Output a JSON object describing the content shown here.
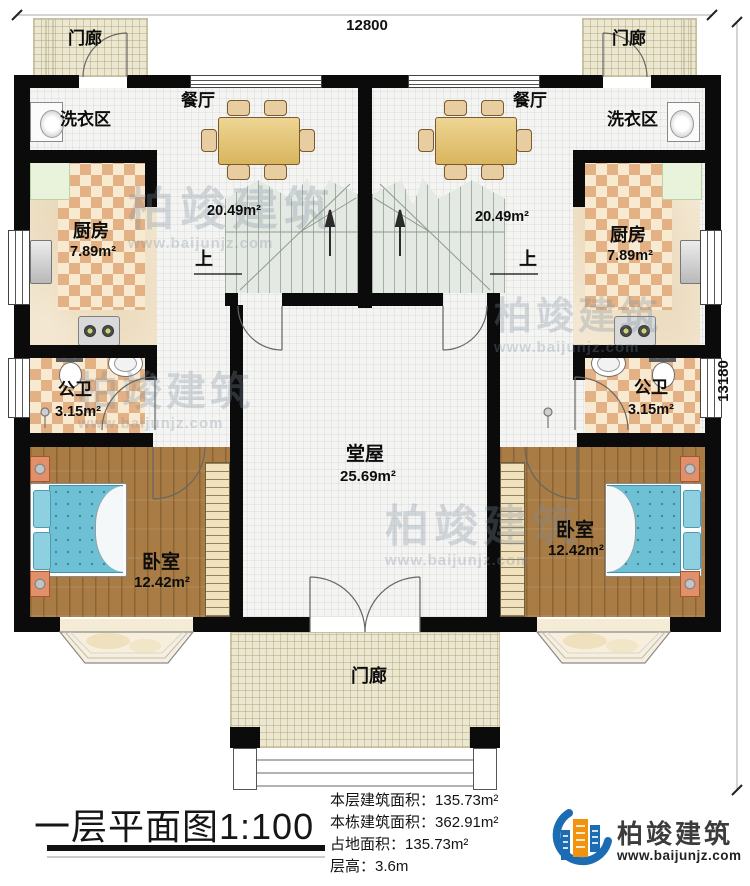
{
  "dimensions": {
    "top": "12800",
    "right": "13180"
  },
  "rooms": {
    "porch": "门廊",
    "laundry": "洗衣区",
    "dining": {
      "label": "餐厅",
      "area": "20.49m²"
    },
    "kitchen": {
      "label": "厨房",
      "area": "7.89m²"
    },
    "bath": {
      "label": "公卫",
      "area": "3.15m²"
    },
    "bedroom": {
      "label": "卧室",
      "area": "12.42m²"
    },
    "hall": {
      "label": "堂屋",
      "area": "25.69m²"
    },
    "stairs_up": "上"
  },
  "title_block": {
    "title": "一层平面图1:100",
    "info": [
      {
        "label": "本层建筑面积：",
        "value": "135.73m²"
      },
      {
        "label": "本栋建筑面积：",
        "value": "362.91m²"
      },
      {
        "label": "占地面积：",
        "value": "135.73m²"
      },
      {
        "label": "层高：",
        "value": "3.6m"
      }
    ],
    "logo": {
      "name": "柏竣建筑",
      "url": "www.baijunjz.com"
    }
  },
  "watermark": {
    "name": "柏竣建筑",
    "url": "www.baijunjz.com"
  }
}
